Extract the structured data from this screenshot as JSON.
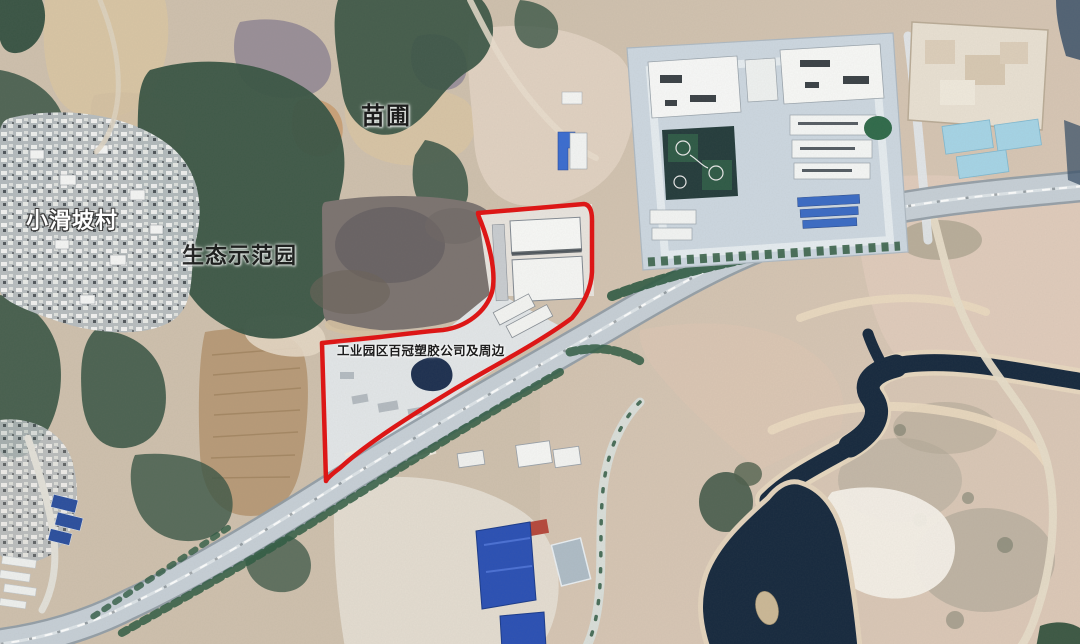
{
  "map": {
    "labels": {
      "nursery": "苗圃",
      "village": "小滑坡村",
      "eco_park": "生态示范园",
      "boundary_area": "工业园区百冠塑胶公司及周边"
    },
    "colors": {
      "boundary_red": "#e01212",
      "river_water": "#16293e",
      "pond_blue": "#2a50b4",
      "pond_light_blue": "#a5d4e6",
      "blue_roof": "#3a6bc4",
      "forest_green": "#3a5545",
      "highway_surface": "#c6cfd6",
      "earth_tan": "#cec0ad",
      "earth_pink": "#e2cfc2",
      "sand_white": "#f4efe7"
    }
  }
}
